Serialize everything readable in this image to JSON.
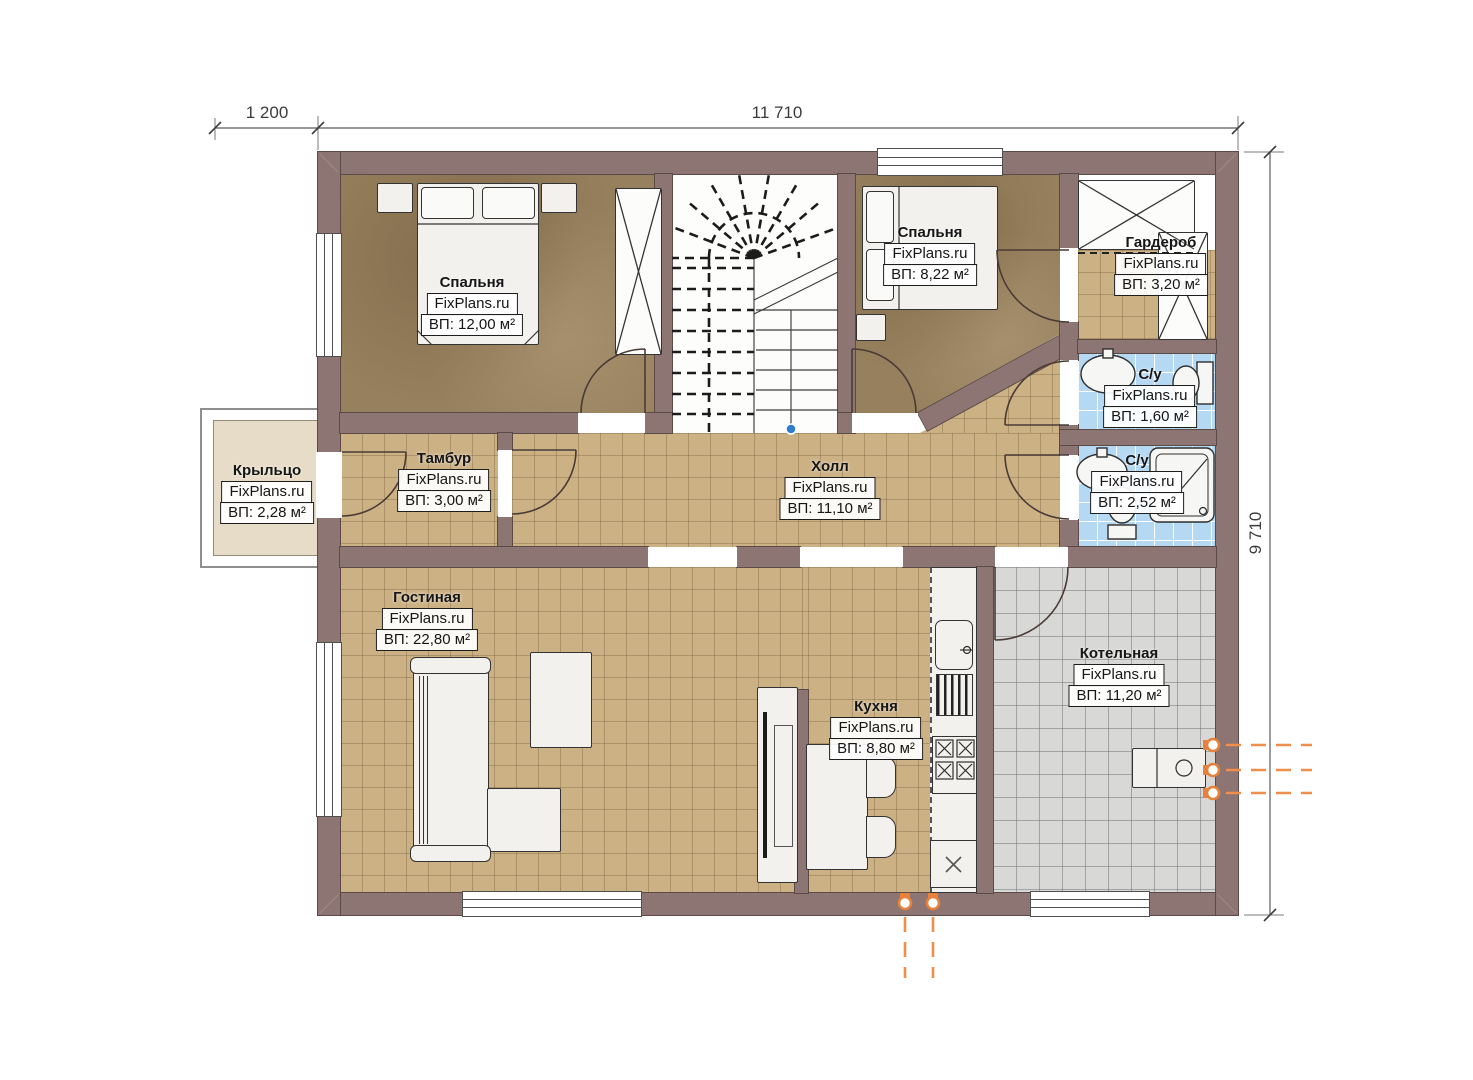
{
  "watermark": "FixPlans.ru",
  "dimensions": {
    "porch_width": "1 200",
    "building_width": "11 710",
    "building_height": "9 710"
  },
  "rooms": [
    {
      "key": "bedroom-1",
      "name": "Спальня",
      "area": "ВП: 12,00 м²"
    },
    {
      "key": "bedroom-2",
      "name": "Спальня",
      "area": "ВП: 8,22 м²"
    },
    {
      "key": "wardrobe",
      "name": "Гардероб",
      "area": "ВП: 3,20 м²"
    },
    {
      "key": "bathroom-1",
      "name": "С/у",
      "area": "ВП: 1,60 м²"
    },
    {
      "key": "bathroom-2",
      "name": "С/у",
      "area": "ВП: 2,52 м²"
    },
    {
      "key": "porch",
      "name": "Крыльцо",
      "area": "ВП: 2,28 м²"
    },
    {
      "key": "vestibule",
      "name": "Тамбур",
      "area": "ВП: 3,00 м²"
    },
    {
      "key": "hall",
      "name": "Холл",
      "area": "ВП: 11,10 м²"
    },
    {
      "key": "living-room",
      "name": "Гостиная",
      "area": "ВП: 22,80 м²"
    },
    {
      "key": "kitchen",
      "name": "Кухня",
      "area": "ВП: 8,80 м²"
    },
    {
      "key": "boiler-room",
      "name": "Котельная",
      "area": "ВП: 11,20 м²"
    }
  ],
  "colors": {
    "wall": "#8d7573",
    "floor_tile_tan": "#ccb185",
    "floor_bedroom_brown": "#97805d",
    "floor_bathroom_blue": "#b5d8f3",
    "floor_boiler_gray": "#d8d8d7",
    "porch_beige": "#e7dcc7",
    "utility_orange": "#e8813b",
    "stair_start_dot_blue": "#2d7dd2"
  }
}
